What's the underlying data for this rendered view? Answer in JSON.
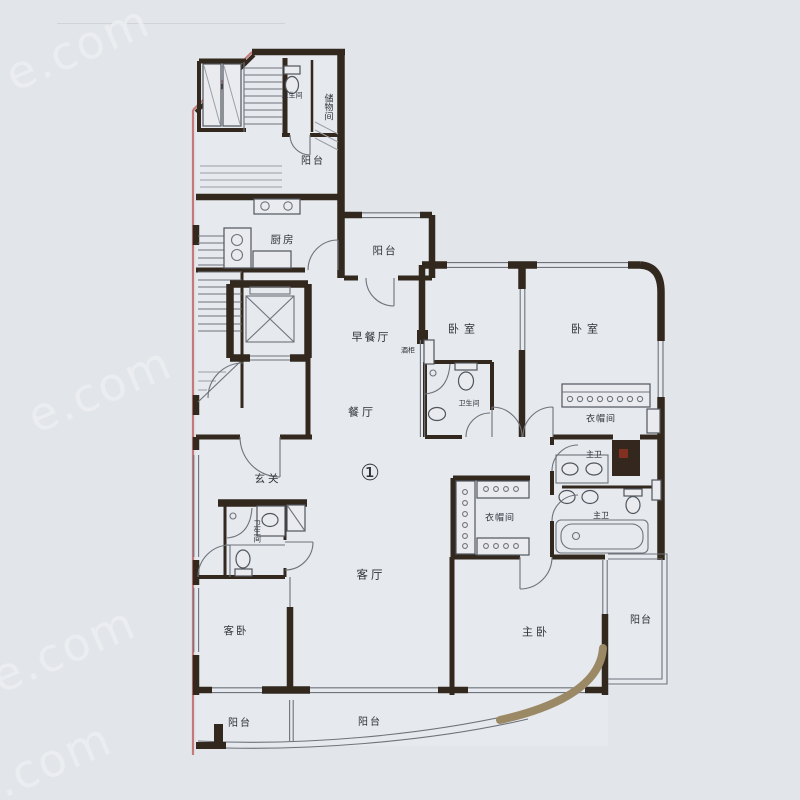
{
  "unit_badge": "①",
  "watermark": {
    "text": "e.com"
  },
  "rooms": {
    "bathroom": "卫生间",
    "storage_room": "储物间",
    "balcony": "阳台",
    "kitchen": "厨房",
    "breakfast_room": "早餐厅",
    "wine_cabinet": "酒柜",
    "dining_room": "餐厅",
    "bedroom": "卧室",
    "cloakroom": "衣帽间",
    "foyer": "玄关",
    "master_bathroom": "主卫",
    "living_room": "客厅",
    "guest_bedroom": "客卧",
    "master_bedroom": "主卧"
  },
  "colors": {
    "background": "#e2e5e9",
    "wall": "#33281e",
    "thin_line": "#6e737b",
    "border_red": "#c5797b",
    "curve_tan": "#9b8966",
    "label": "#2e333a",
    "watermark": "#eef0f3",
    "shaft_fill": "#34271d",
    "shaft_dot": "#82301f"
  }
}
